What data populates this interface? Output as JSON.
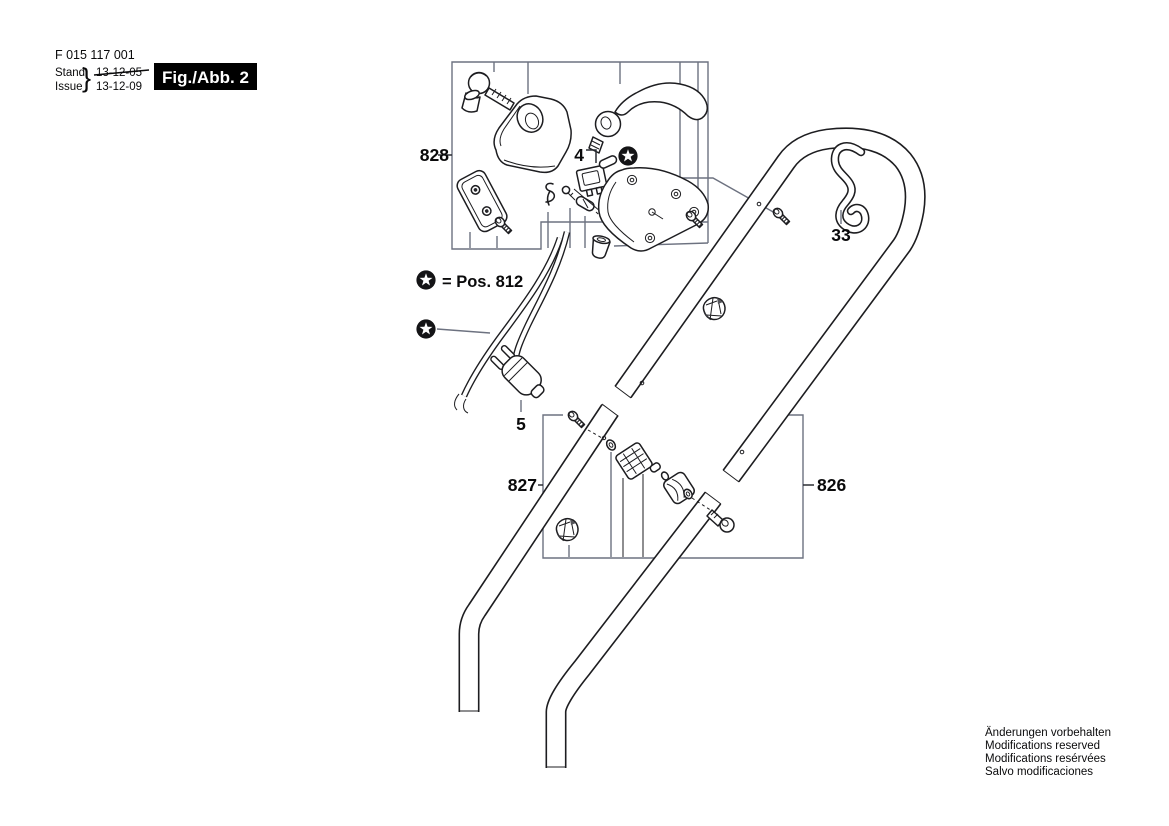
{
  "header": {
    "part_number": "F 015 117 001",
    "stand_label": "Stand",
    "stand_date": "13-12-05",
    "issue_label": "Issue",
    "issue_date": "13-12-09",
    "brace": "}",
    "figure_label": "Fig./Abb. 2"
  },
  "legend": {
    "equals_text": "= Pos. 812"
  },
  "labels": {
    "switch_assembly": "828",
    "switch_part": "4",
    "cable_hook": "33",
    "lower_handle_left": "827",
    "upper_handle_right": "826",
    "power_plug": "5"
  },
  "footer": {
    "lines": [
      "Änderungen vorbehalten",
      "Modifications reserved",
      "Modifications resérvées",
      "Salvo modificaciones"
    ]
  },
  "colors": {
    "line": "#1d1d20",
    "leader": "#6d7280",
    "text": "#0a0a0b",
    "figure_badge_bg": "#000000",
    "figure_badge_fg": "#ffffff",
    "background": "#ffffff"
  }
}
